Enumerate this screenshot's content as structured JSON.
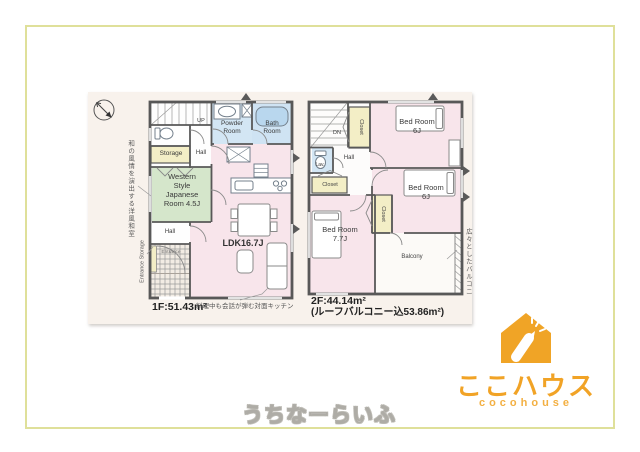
{
  "frame": {
    "border_color": "#dfe09a"
  },
  "floor1": {
    "area_label": "1F:51.43m²",
    "kitchen_caption": "料理中も会話が弾む対面キッチン",
    "note_japanese_room": "和の風情を演出する洋風和室",
    "note_entrance_storage": "Entrance Storage",
    "labels": {
      "up": "UP",
      "powder_room": "Powder Room",
      "bath_room": "Bath Room",
      "storage": "Storage",
      "hall_upper": "Hall",
      "japanese_room": "Western Style Japanese Room 4.5J",
      "ldk": "LDK16.7J",
      "hall_lower": "Hall",
      "entrance": "Entrance"
    }
  },
  "floor2": {
    "area_label": "2F:44.14m²",
    "area_note": "(ルーフバルコニー込53.86m²)",
    "note_balcony": "広々としたバルコニー",
    "labels": {
      "dn": "DN",
      "closet_top": "Closet",
      "lavatory": "Lav.",
      "hall": "Hall",
      "closet_left": "Closet",
      "closet_mid": "Closet",
      "bedroom_a": "Bed Room 6J",
      "bedroom_b": "Bed Room 6J",
      "bedroom_c": "Bed Room 7.7J",
      "balcony": "Balcony"
    }
  },
  "logo": {
    "name_jp": "ここハウス",
    "name_en": "cocohouse",
    "brand_color": "#f0a426"
  },
  "watermark": "うちなーらいふ"
}
